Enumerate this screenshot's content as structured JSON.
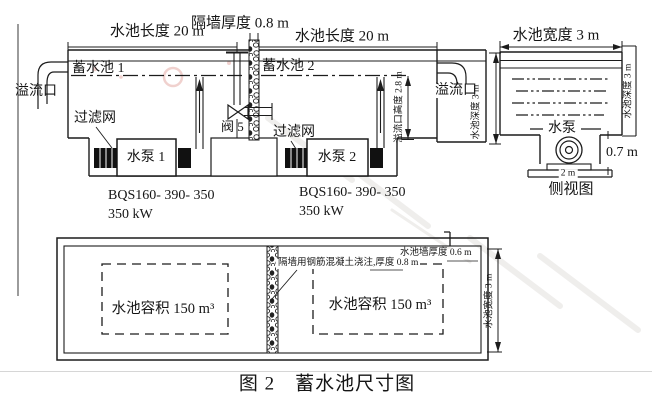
{
  "figure": {
    "caption": "图 2　蓄水池尺寸图"
  },
  "elevation": {
    "dim_length_left": "水池长度 20 m",
    "dim_partition_thickness": "隔墙厚度 0.8 m",
    "dim_length_right": "水池长度 20 m",
    "tank1_label": "蓄水池 1",
    "tank2_label": "蓄水池 2",
    "overflow_left": "溢流口",
    "overflow_right": "溢流口",
    "filter_left": "过滤网",
    "filter_right": "过滤网",
    "valve_label": "阀 5",
    "pump1_label": "水泵 1",
    "pump2_label": "水泵 2",
    "pump1_model": "BQS160- 390- 350",
    "pump1_power": "350 kW",
    "pump2_model": "BQS160- 390- 350",
    "pump2_power": "350 kW",
    "dim_overflow_height": "溢流口高度 2.8 m",
    "dim_pool_depth": "水池深度 3 m"
  },
  "side_view": {
    "dim_width": "水池宽度 3 m",
    "pump_label": "水泵",
    "dim_pump_height": "0.7 m",
    "dim_sump_width": "2 m",
    "view_caption": "侧视图",
    "dim_depth": "水池深度 3 m"
  },
  "plan_view": {
    "note_wall_thickness": "水池墙厚度 0.6 m",
    "note_partition": "隔墙用钢筋混凝土浇注,厚度 0.8 m",
    "volume_left": "水池容积 150 m³",
    "volume_right": "水池容积 150 m³",
    "dim_width": "水池宽度 3 m"
  },
  "colors": {
    "line": "#1c1c1c",
    "stamp_red": "#d06a5f",
    "watermark_gray": "#b9b3ae"
  }
}
